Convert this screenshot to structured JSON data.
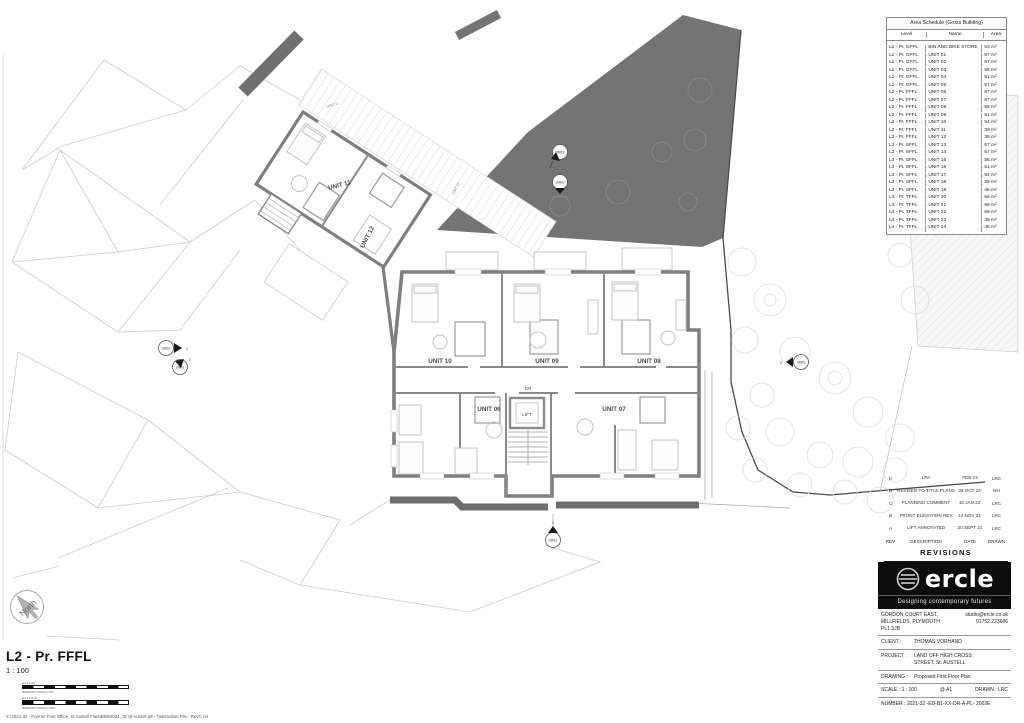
{
  "plan": {
    "units": [
      {
        "label": "UNIT 10"
      },
      {
        "label": "UNIT 09"
      },
      {
        "label": "UNIT 08"
      },
      {
        "label": "UNIT 06"
      },
      {
        "label": "UNIT 07"
      },
      {
        "label": "UNIT 11"
      },
      {
        "label": "UNIT 12"
      }
    ],
    "small_labels": [
      {
        "label": "UNIT 11"
      },
      {
        "label": "UNIT 12"
      }
    ],
    "rooms": {
      "lift": "LIFT",
      "dr": "DR"
    },
    "markers": [
      {
        "label": "3003",
        "ref": ""
      },
      {
        "label": "3000",
        "ref": ""
      },
      {
        "label": "3002",
        "ref": "1"
      },
      {
        "label": "3001",
        "ref": "2"
      },
      {
        "label": "3002",
        "ref": "2"
      },
      {
        "label": "3001",
        "ref": "1"
      }
    ],
    "north_label": "North"
  },
  "area_schedule": {
    "title": "Area Schedule (Gross Building)",
    "columns": [
      "Level",
      "Name",
      "Area"
    ],
    "rows": [
      {
        "level": "L1 - Pr. GFFL",
        "name": "BIN AND BIKE STORE",
        "area": "63 m²"
      },
      {
        "level": "L1 - Pr. GFFL",
        "name": "UNIT 01",
        "area": "67 m²"
      },
      {
        "level": "L1 - Pr. GFFL",
        "name": "UNIT 02",
        "area": "67 m²"
      },
      {
        "level": "L1 - Pr. GFFL",
        "name": "UNIT 03",
        "area": "56 m²"
      },
      {
        "level": "L1 - Pr. GFFL",
        "name": "UNIT 04",
        "area": "51 m²"
      },
      {
        "level": "L1 - Pr. GFFL",
        "name": "UNIT 05",
        "area": "57 m²"
      },
      {
        "level": "L2 - Pr. FFFL",
        "name": "UNIT 06",
        "area": "67 m²"
      },
      {
        "level": "L2 - Pr. FFFL",
        "name": "UNIT 07",
        "area": "67 m²"
      },
      {
        "level": "L2 - Pr. FFFL",
        "name": "UNIT 08",
        "area": "56 m²"
      },
      {
        "level": "L2 - Pr. FFFL",
        "name": "UNIT 09",
        "area": "51 m²"
      },
      {
        "level": "L2 - Pr. FFFL",
        "name": "UNIT 10",
        "area": "54 m²"
      },
      {
        "level": "L2 - Pr. FFFL",
        "name": "UNIT 11",
        "area": "39 m²"
      },
      {
        "level": "L2 - Pr. FFFL",
        "name": "UNIT 12",
        "area": "39 m²"
      },
      {
        "level": "L3 - Pr. SFFL",
        "name": "UNIT 13",
        "area": "67 m²"
      },
      {
        "level": "L3 - Pr. SFFL",
        "name": "UNIT 14",
        "area": "67 m²"
      },
      {
        "level": "L3 - Pr. SFFL",
        "name": "UNIT 15",
        "area": "56 m²"
      },
      {
        "level": "L3 - Pr. SFFL",
        "name": "UNIT 16",
        "area": "51 m²"
      },
      {
        "level": "L3 - Pr. SFFL",
        "name": "UNIT 17",
        "area": "54 m²"
      },
      {
        "level": "L3 - Pr. SFFL",
        "name": "UNIT 18",
        "area": "39 m²"
      },
      {
        "level": "L3 - Pr. SFFL",
        "name": "UNIT 19",
        "area": "46 m²"
      },
      {
        "level": "L4 - Pr. TFFL",
        "name": "UNIT 20",
        "area": "56 m²"
      },
      {
        "level": "L4 - Pr. TFFL",
        "name": "UNIT 21",
        "area": "99 m²"
      },
      {
        "level": "L4 - Pr. TFFL",
        "name": "UNIT 22",
        "area": "69 m²"
      },
      {
        "level": "L4 - Pr. TFFL",
        "name": "UNIT 23",
        "area": "39 m²"
      },
      {
        "level": "L4 - Pr. TFFL",
        "name": "UNIT 24",
        "area": "46 m²"
      }
    ]
  },
  "revisions": {
    "title": "REVISIONS",
    "columns": [
      "REV",
      "DESCRIPTION",
      "DATE",
      "DRAWN"
    ],
    "rows": [
      {
        "rev": "E",
        "description": "LPA",
        "date": "FEB 23",
        "drawn": "LRC"
      },
      {
        "rev": "D",
        "description": "REVISED TO TITLE PLANS",
        "date": "25 OCT 22'",
        "drawn": "NH"
      },
      {
        "rev": "C",
        "description": "PLANNING COMMENT",
        "date": "10 JAN 22'",
        "drawn": "LRC"
      },
      {
        "rev": "B",
        "description": "FRONT ELEVATION REV",
        "date": "12 NOV 21'",
        "drawn": "LRC"
      },
      {
        "rev": "A",
        "description": "LIFT ANNOTATED",
        "date": "20 SEPT 21",
        "drawn": "LRC"
      }
    ]
  },
  "title_block": {
    "logo_text": "ercle",
    "logo_tagline": "Designing contemporary futures",
    "address_line1": "GORDON COURT EAST,",
    "address_line2": "MILLFIELDS, PLYMOUTH",
    "address_line3": "PL1 3JB",
    "email": "studio@ercle.co.uk",
    "phone": "01752 223686",
    "client_label": "CLIENT :",
    "client": "THOMAS VORHAND",
    "project_label": "PROJECT :",
    "project_line1": "LAND OFF HIGH CROSS",
    "project_line2": "STREET, St. AUSTELL",
    "drawing_label": "DRAWING :",
    "drawing": "Proposed First Floor Plan",
    "scale_label": "SCALE : 1 : 100",
    "sheet_size": "@ A1",
    "drawn_by": "DRAWN : LRC",
    "number": "NUMBER : 2021-32  -ED-B1-XX-DR-A-PL- 2002E"
  },
  "sheet": {
    "view_title": "L2 - Pr. FFFL",
    "view_scale": "1 : 100",
    "scalebar1_label": "GRAPHIC SCALE 1:50",
    "scalebar1_ticks": "0 1 2 3 4 5",
    "scalebar2_label": "GRAPHIC SCALE 1:100",
    "scalebar2_ticks": "0 2 4 6 8 10",
    "file_path": "X:\\2021-32 - Former Post Office, St Austell Flats\\BIM\\2021_32 St Austell p9 - Twinmotion File - RevC.rvt"
  },
  "colors": {
    "wall": "#7f7f7f",
    "dark_area": "#747474",
    "accent_black": "#101010"
  }
}
